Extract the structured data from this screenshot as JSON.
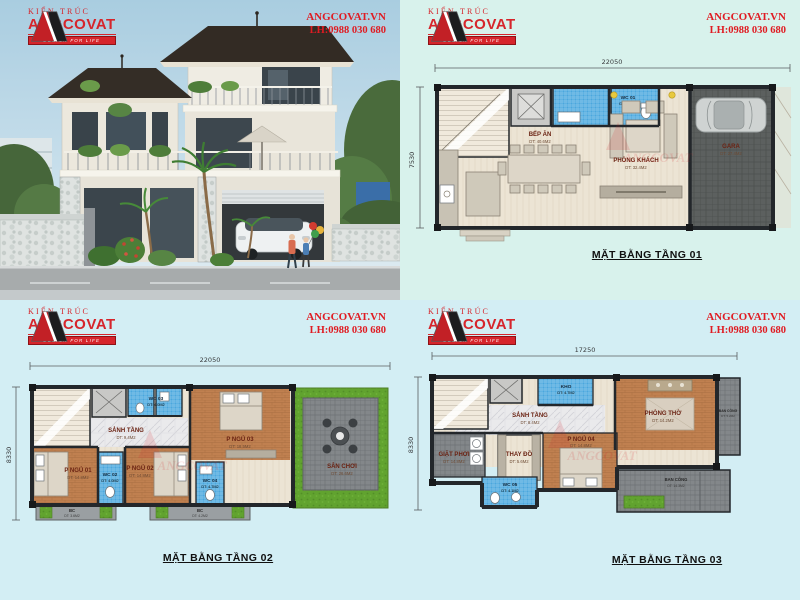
{
  "brand": {
    "field": "KIẾN TRÚC",
    "name": "ANGCOVAT",
    "slogan": "DESIGN FOR LIFE",
    "website": "ANGCOVAT.VN",
    "hotline": "LH:0988 030 680",
    "watermark": "ANGCOVAT"
  },
  "colors": {
    "accent_red": "#d6252b",
    "panel_bg_mint": "#d8f2ec",
    "panel_bg_cyan": "#d3eef4",
    "wc_blue": "#4aa7dd",
    "wood_floor": "#c08050",
    "grass_green": "#61a32f",
    "wall_dark": "#23272b"
  },
  "floor1": {
    "title": "MẶT BẰNG TẦNG 01",
    "dim_width": "22050",
    "dim_depth": "7530",
    "rooms": [
      {
        "name": "BẾP ĂN",
        "area": "DT: 40.6M2"
      },
      {
        "name": "PHÒNG KHÁCH",
        "area": "DT: 32.4M2"
      },
      {
        "name": "GARA",
        "area": "DT: 27.4M2"
      },
      {
        "name": "WC 01",
        "area": "DT: 4.7M2"
      }
    ]
  },
  "floor2": {
    "title": "MẶT BẰNG TẦNG 02",
    "dim_width": "22050",
    "dim_depth": "8330",
    "rooms": [
      {
        "name": "SẢNH TẦNG",
        "area": "DT: 9.4M2"
      },
      {
        "name": "P NGỦ 01",
        "area": "DT: 14.8M2"
      },
      {
        "name": "WC 02",
        "area": "DT: 4.0M2"
      },
      {
        "name": "P NGỦ 02",
        "area": "DT: 14.8M2"
      },
      {
        "name": "WC 04",
        "area": "DT: 4.7M2"
      },
      {
        "name": "P NGỦ 03",
        "area": "DT: 18.5M2"
      },
      {
        "name": "WC 03",
        "area": "DT: 4.0M2"
      },
      {
        "name": "SÂN CHƠI",
        "area": "DT: 26.6M2"
      },
      {
        "name": "BC",
        "area": "DT: 3.6M2"
      },
      {
        "name": "BC",
        "area": "DT: 4.2M2"
      }
    ]
  },
  "floor3": {
    "title": "MẶT BẰNG TẦNG 03",
    "dim_width": "17250",
    "dim_depth": "8330",
    "rooms": [
      {
        "name": "SẢNH TẦNG",
        "area": "DT: 8.4M2"
      },
      {
        "name": "KHO",
        "area": "DT: 4.7M2"
      },
      {
        "name": "PHÒNG THỜ",
        "area": "DT: 14.2M2"
      },
      {
        "name": "BAN CÔNG",
        "area": "DT: 5.2M2"
      },
      {
        "name": "GIẶT PHƠI",
        "area": "DT: 14.8M2"
      },
      {
        "name": "THAY ĐỒ",
        "area": "DT: 5.6M2"
      },
      {
        "name": "P NGỦ 04",
        "area": "DT: 14.8M2"
      },
      {
        "name": "WC 05",
        "area": "DT: 4.1M2"
      },
      {
        "name": "BAN CÔNG",
        "area": "DT: 14.3M2"
      }
    ]
  }
}
